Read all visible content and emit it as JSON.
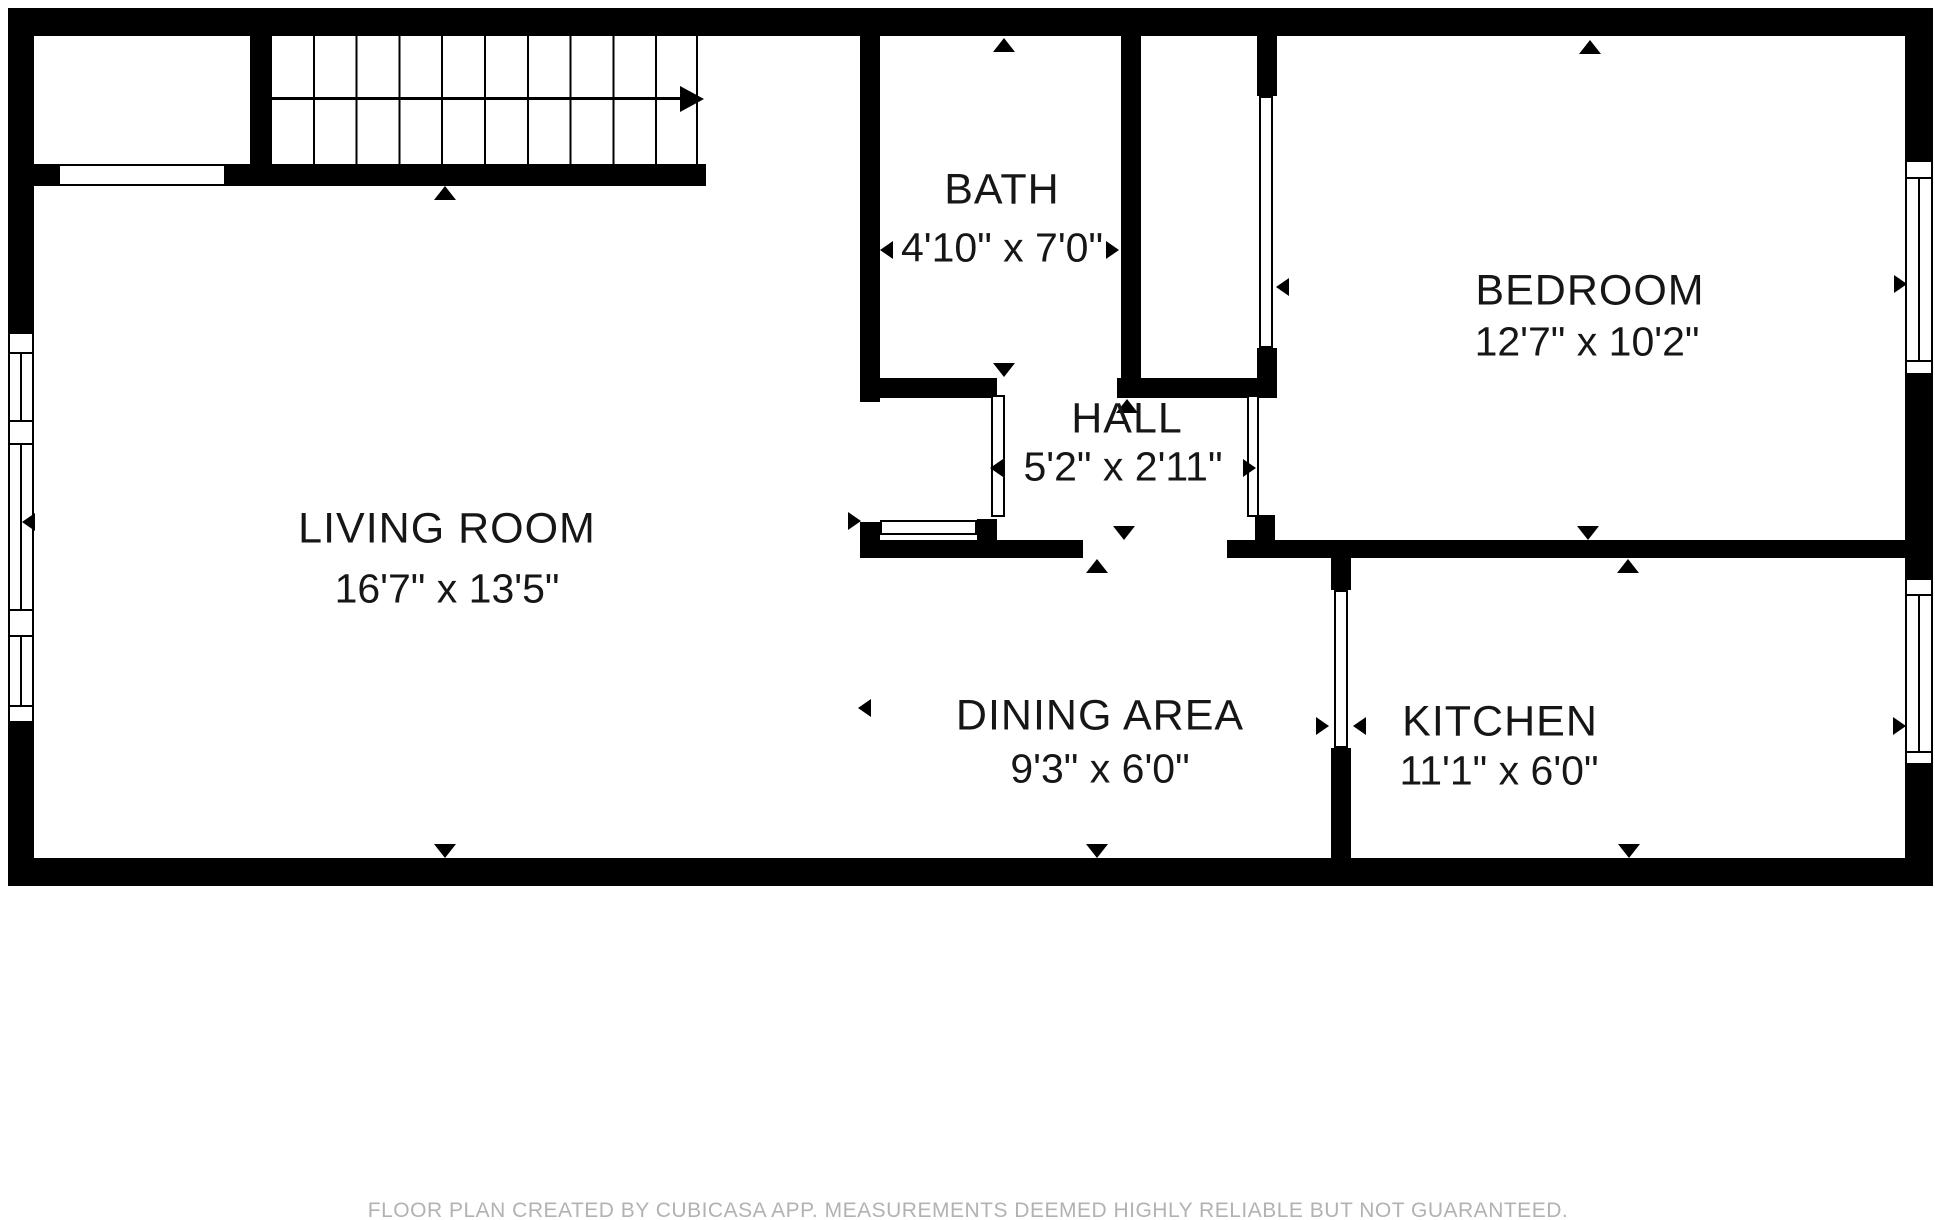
{
  "plan": {
    "rooms": {
      "living": {
        "name": "LIVING ROOM",
        "dims": "16'7\" x 13'5\""
      },
      "bath": {
        "name": "BATH",
        "dims": "4'10\" x 7'0\""
      },
      "hall": {
        "name": "HALL",
        "dims": "5'2\" x 2'11\""
      },
      "bedroom": {
        "name": "BEDROOM",
        "dims": "12'7\" x 10'2\""
      },
      "dining": {
        "name": "DINING AREA",
        "dims": "9'3\" x 6'0\""
      },
      "kitchen": {
        "name": "KITCHEN",
        "dims": "11'1\" x 6'0\""
      }
    },
    "footer": {
      "disclaimer": "FLOOR PLAN CREATED BY CUBICASA APP. MEASUREMENTS DEEMED HIGHLY RELIABLE BUT NOT GUARANTEED."
    },
    "colors": {
      "wall": "#000000",
      "text": "#161616",
      "footer_text": "#b2b2b2",
      "background": "#ffffff"
    }
  }
}
